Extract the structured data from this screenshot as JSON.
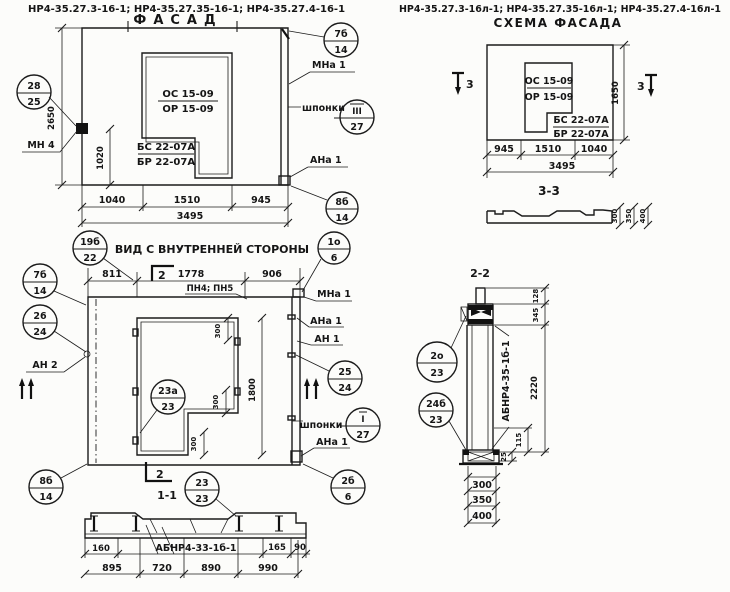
{
  "titles": {
    "left_codes": "НР4-35.27.3-16-1; НР4-35.27.35-16-1; НР4-35.27.4-16-1",
    "right_codes": "НР4-35.27.3-16л-1; НР4-35.27.35-16л-1; НР4-35.27.4-16л-1",
    "facade": "ФАСАД",
    "schema": "СХЕМА ФАСАДА",
    "inner_view": "ВИД С ВНУТРЕННЕЙ СТОРОНЫ",
    "sec11": "1-1",
    "sec22": "2-2",
    "sec33": "3-3"
  },
  "facade": {
    "opening_top": "ОС 15-09",
    "opening_bottom": "ОР 15-09",
    "block_top": "БС 22-07А",
    "block_bottom": "БР 22-07А",
    "dim_height": "2650",
    "dim_inner": "1020",
    "dims": [
      "1040",
      "1510",
      "945"
    ],
    "total": "3495",
    "balloon_left": [
      "28",
      "25"
    ],
    "balloon_tr": [
      "7б",
      "14"
    ],
    "balloon_keys": [
      "III",
      "27"
    ],
    "balloon_br": [
      "8б",
      "14"
    ],
    "mn4": "МН 4",
    "mna1": "МНа 1",
    "shponki": "шпонки",
    "ana1": "АНа 1"
  },
  "inner": {
    "dims_top": [
      "811",
      "1778",
      "906"
    ],
    "pn": "ПН4; ПН5",
    "mna1": "МНа 1",
    "ana1_a": "АНа 1",
    "an1": "АН 1",
    "an2": "АН 2",
    "ana1_b": "АНа 1",
    "shponki": "шпонки",
    "mark2": "2",
    "balloon_19": [
      "19б",
      "22"
    ],
    "balloon_1o": [
      "1о",
      "6"
    ],
    "balloon_7b": [
      "7б",
      "14"
    ],
    "balloon_26": [
      "26",
      "24"
    ],
    "balloon_25": [
      "25",
      "24"
    ],
    "balloon_23a": [
      "23а",
      "23"
    ],
    "balloon_keys": [
      "I",
      "27"
    ],
    "balloon_2b": [
      "2б",
      "6"
    ],
    "balloon_8b": [
      "8б",
      "14"
    ],
    "dim_300a": "300",
    "dim_300b": "300",
    "dim_300c": "300",
    "dim_1800": "1800"
  },
  "sec11": {
    "balloon_23": [
      "23",
      "23"
    ],
    "dims_upper": [
      "160",
      "165",
      "90"
    ],
    "beam": "АБНР4-33-1б-1",
    "dims": [
      "895",
      "720",
      "890",
      "990"
    ]
  },
  "schema": {
    "opening_top": "ОС 15-09",
    "opening_bottom": "ОР 15-09",
    "block_top": "БС 22-07А",
    "block_bottom": "БР 22-07А",
    "dims": [
      "945",
      "1510",
      "1040"
    ],
    "total": "3495",
    "dim_height": "1650",
    "mark3": "3"
  },
  "sec33": {
    "dims": [
      "300",
      "350",
      "400"
    ]
  },
  "sec22": {
    "beam": "АБНР4-35-1б-1",
    "dim_128": "128",
    "dim_345": "345",
    "dim_2220": "2220",
    "dim_115": "115",
    "dim_25": "25",
    "dims_bottom": [
      "300",
      "350",
      "400"
    ],
    "balloon_2o": [
      "2о",
      "23"
    ],
    "balloon_24b": [
      "24б",
      "23"
    ]
  }
}
